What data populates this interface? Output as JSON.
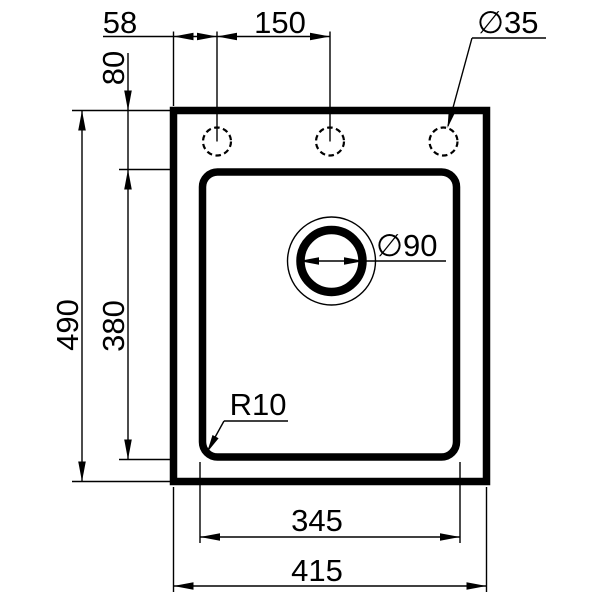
{
  "drawing": {
    "colors": {
      "ink": "#000000",
      "background": "#ffffff"
    },
    "labels": {
      "d58": "58",
      "d150": "150",
      "d80": "80",
      "d490": "490",
      "d380": "380",
      "d345": "345",
      "d415": "415",
      "hole_dia": "∅35",
      "drain_dia": "∅90",
      "corner_r": "R10"
    }
  }
}
